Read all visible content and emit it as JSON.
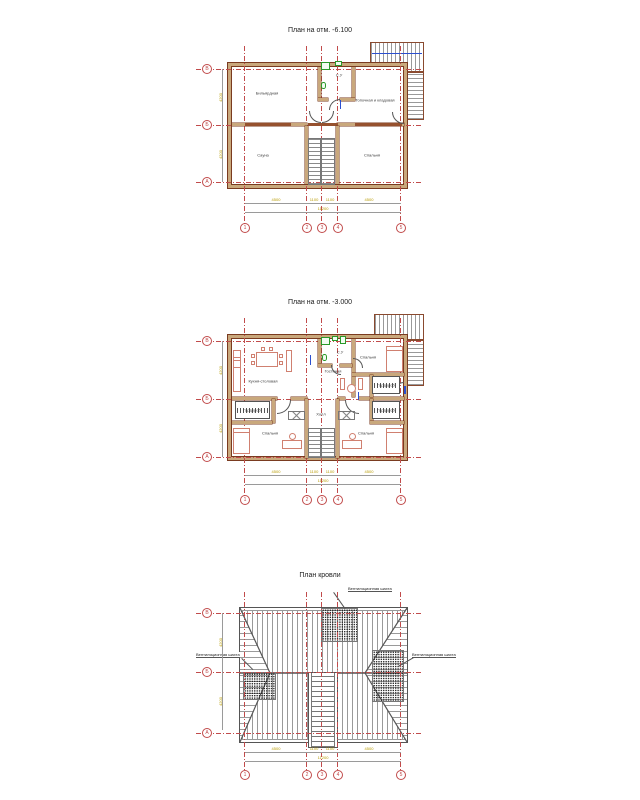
{
  "titles": {
    "plan1": "План на отм. -6.100",
    "plan2": "План на отм. -3.000",
    "plan3": "План кровли"
  },
  "grid": {
    "rows": [
      "В",
      "Б",
      "А"
    ],
    "cols": [
      "1",
      "2",
      "3",
      "4",
      "5"
    ]
  },
  "dims": {
    "spans": [
      "4500",
      "1100",
      "1100",
      "4500"
    ],
    "total": "11200",
    "verticals": [
      "4200",
      "4200"
    ]
  },
  "basement": {
    "rooms": {
      "billiard": "Бильярдная",
      "boiler": "Топочная и кладовая",
      "wc": "С.У",
      "sauna": "Сауна",
      "bedroom": "Спальня"
    }
  },
  "floor": {
    "rooms": {
      "kitchen": "Кухня-столовая",
      "living": "Гостиная",
      "wc": "С.У",
      "bedroom1": "Спальня",
      "bedroom2": "Спальня",
      "bedroom3": "Спальня",
      "wardrobe1": "Гардероб",
      "wardrobe2": "Гардероб",
      "wardrobe3": "Гардероб",
      "hall": "Холл"
    }
  },
  "roof": {
    "annotation": "Вентиляционная шахта"
  },
  "colors": {
    "axis": "#c14b4b",
    "wall_fill": "#c9a87c",
    "wall_edge": "#7a3b20",
    "dim_text": "#b89b00",
    "furniture": "#d08070",
    "fixture": "#2a9a2a",
    "roof_line": "#8a8a8a"
  }
}
